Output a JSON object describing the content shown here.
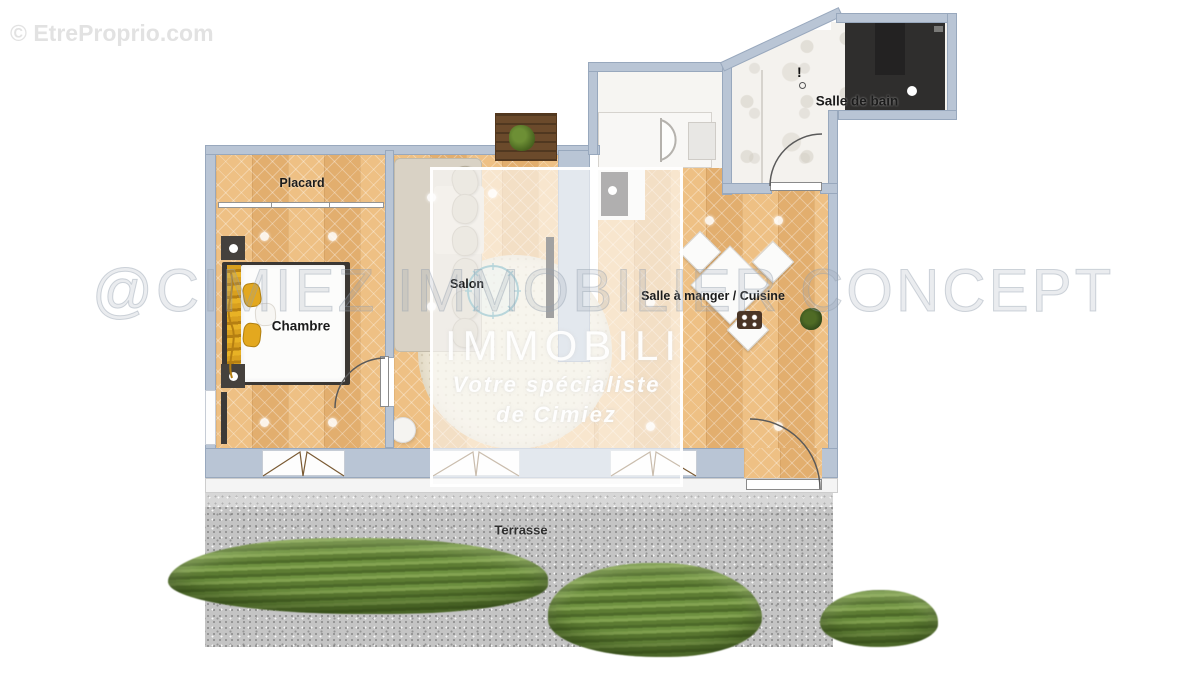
{
  "watermarks": {
    "copyright": "© EtreProprio.com",
    "brand_overlay": "@CIMIEZ IMMOBILIER CONCEPT",
    "center_box": {
      "title": "IMMOBILI",
      "tagline_line1": "Votre spécialiste",
      "tagline_line2": "de Cimiez"
    }
  },
  "floor_plan": {
    "rooms": [
      {
        "label": "Placard"
      },
      {
        "label": "Chambre"
      },
      {
        "label": "Salon"
      },
      {
        "label": "Salle à manger / Cuisine"
      },
      {
        "label": "Salle de bain"
      },
      {
        "label": "Terrasse"
      }
    ],
    "symbols": {
      "bathroom_warning": "!"
    },
    "colors": {
      "wall": "#b9c5d5",
      "parquet": "#e8b87c",
      "bathroom_floor": "#f4f2ee",
      "terrace": "#c4c4c4",
      "hedge_green": "#6e9140",
      "bed_accent_gold": "#d9a01e",
      "coffee_table_teal": "#4f98a6"
    }
  }
}
